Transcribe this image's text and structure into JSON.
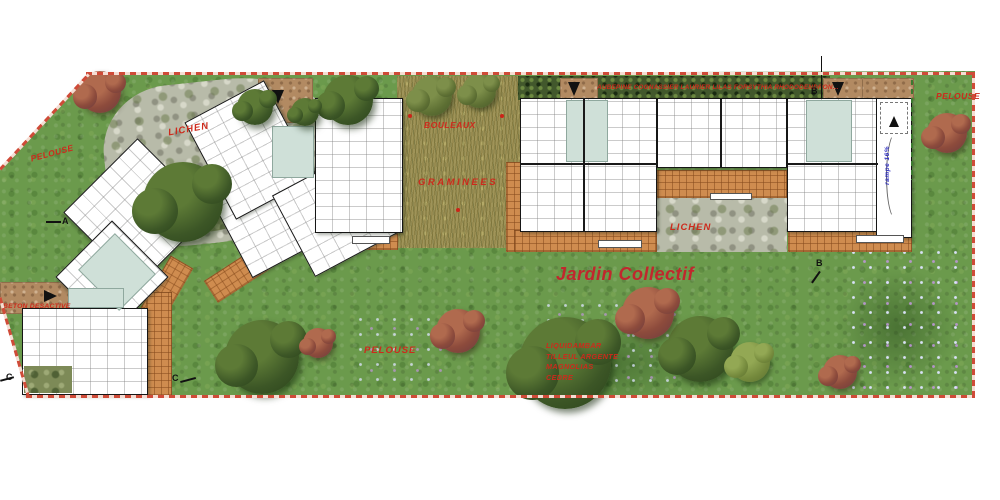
{
  "areas": {
    "pelouse_left": "PELOUSE",
    "lichen_upper": "LICHEN",
    "bouleaux": "BOULEAUX",
    "graminees": "GRAMINEES",
    "pelouse_top_right": "PELOUSE",
    "lichen_court": "LICHEN",
    "jardin_collectif": "Jardin Collectif",
    "pelouse_bottom": "PELOUSE",
    "beton_desactive": "BETON DESACTIVE"
  },
  "planting": {
    "hedge_species": "AUBEPINE COGNASSIER LAURIER LILAS FORSYTHIA RHODODENDRON...",
    "tree_list": [
      "LIQUIDAMBAR",
      "TILLEUL ARGENTE",
      "MAGNOLIAS",
      "CEDRE"
    ]
  },
  "annotations": {
    "ramp": "rampe 16%",
    "section_a": "A",
    "section_b_top": "B",
    "section_b_bottom": "B",
    "section_c_left": "C",
    "section_c_right": "C"
  },
  "colors": {
    "label_red": "#cd2a1c",
    "jardin_red": "#c1272d",
    "ramp_blue": "#2b2bbd",
    "lawn_green": "#6b9a4c",
    "meadow_tan": "#9f9459",
    "tile_orange": "#cf8c4f",
    "stone_gray": "#b8bba9",
    "hedge_green": "#42582c",
    "walkway_brown": "#b28a62",
    "boundary_red": "#cf4b38",
    "stair_core_teal": "#cfe0d8"
  }
}
